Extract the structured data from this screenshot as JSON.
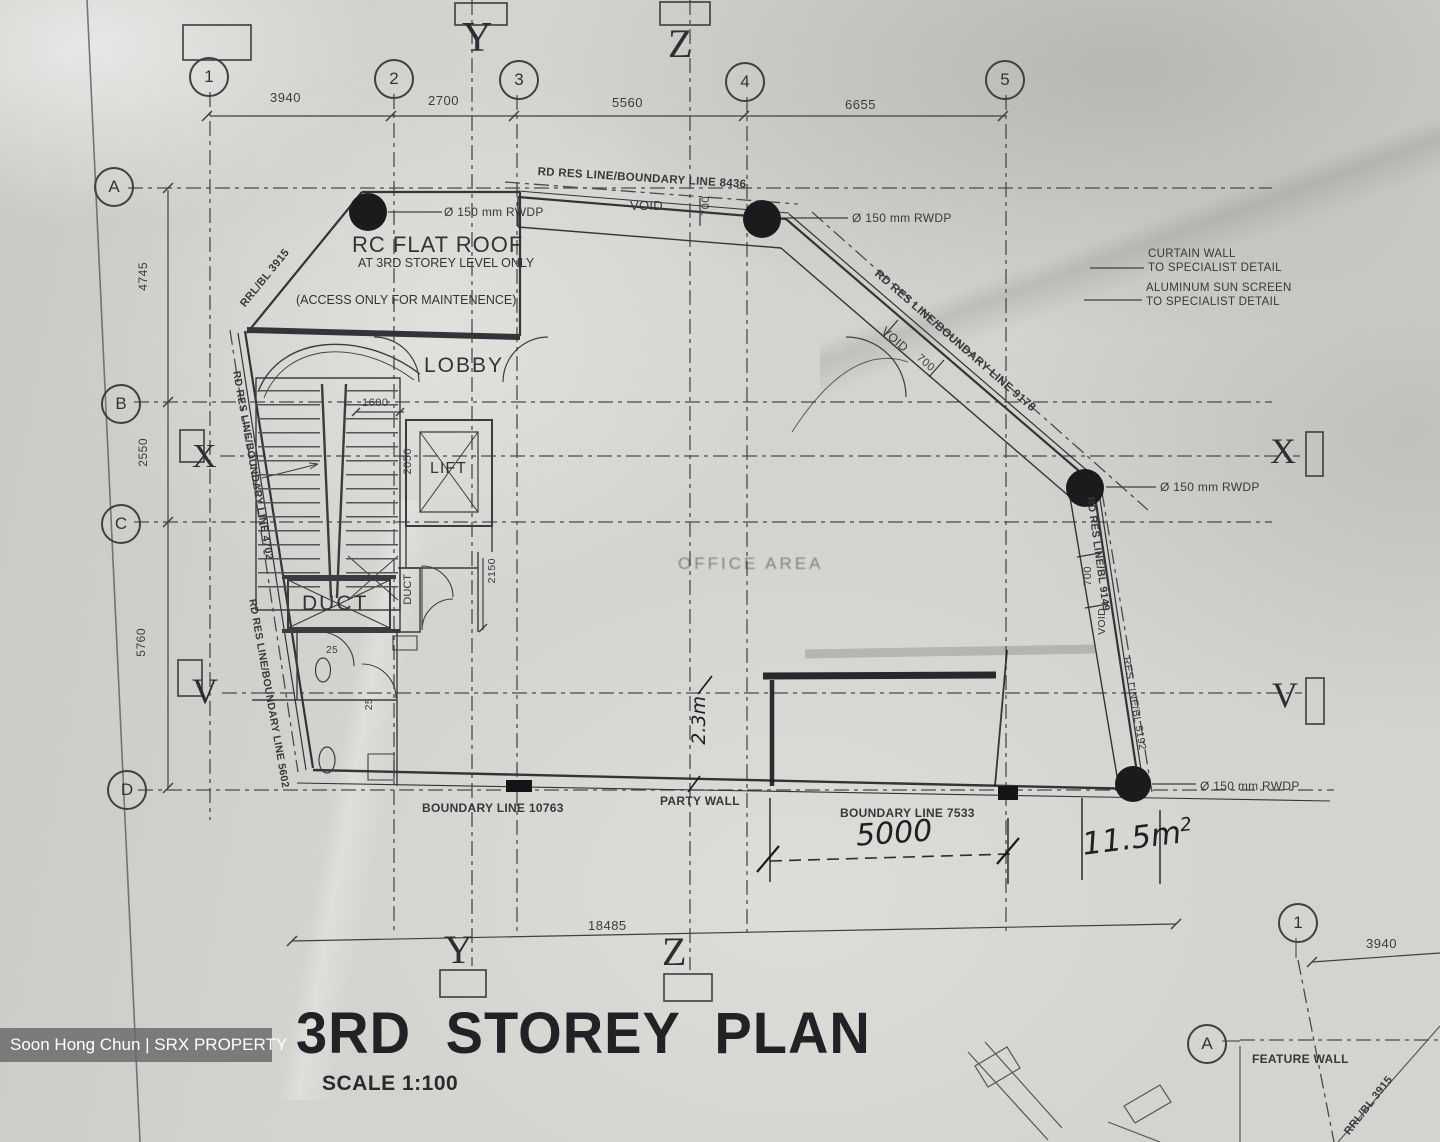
{
  "photo": {
    "watermark": "Soon Hong Chun | SRX PROPERTY"
  },
  "title_block": {
    "title": "3RD STOREY PLAN",
    "scale": "SCALE 1:100"
  },
  "grid": {
    "columns": [
      "1",
      "2",
      "3",
      "4",
      "5"
    ],
    "rows": [
      "A",
      "B",
      "C",
      "D"
    ],
    "column_dims": [
      "3940",
      "2700",
      "5560",
      "6655"
    ],
    "row_dims": [
      "4745",
      "2550",
      "5760"
    ],
    "overall_width_dim": "18485",
    "section_y": "Y",
    "section_z": "Z",
    "section_x": "X",
    "section_v": "V"
  },
  "roof": {
    "line1": "RC FLAT ROOF",
    "line2": "AT 3RD STOREY LEVEL ONLY",
    "line3": "(ACCESS ONLY FOR MAINTENENCE)"
  },
  "rooms": {
    "lobby": "LOBBY",
    "lift": "LIFT",
    "duct_main": "DUCT",
    "duct_small": "DUCT",
    "office_area": "OFFICE AREA"
  },
  "dims": {
    "lift_front": "1600",
    "lift_depth": "2050",
    "duct_depth": "2150",
    "wall_25a": "25",
    "wall_25b": "25",
    "void_top": "700",
    "void_diag": "700",
    "void_right": "700",
    "corner_dim": "3940"
  },
  "voids": {
    "top": "VOID",
    "diag": "VOID",
    "right": "VOID"
  },
  "boundaries": {
    "top": "RD RES LINE/BOUNDARY LINE 8436",
    "diagonal": "RD RES LINE/BOUNDARY LINE 9178",
    "right_upper": "RD RES LINE/BL 9149",
    "right_lower": "RES LINE/BL 5192",
    "left_upper": "RD RES LINE/BOUNDARY LINE 4702",
    "left_lower": "RD RES LINE/BOUNDARY LINE 5602",
    "bottom_left": "BOUNDARY LINE 10763",
    "bottom_right": "BOUNDARY LINE 7533",
    "party_wall": "PARTY WALL",
    "rrl_roof": "RRL/BL 3915",
    "rrl_corner": "RRL/BL 3915"
  },
  "annotations": {
    "rwdp": "Ø 150 mm RWDP",
    "curtain_wall_1": "CURTAIN WALL",
    "curtain_wall_2": "TO SPECIALIST DETAIL",
    "sun_screen_1": "ALUMINUM  SUN SCREEN",
    "sun_screen_2": "TO SPECIALIST DETAIL",
    "feature_wall": "FEATURE WALL",
    "corner_column": "1",
    "corner_row": "A"
  },
  "handwritten": {
    "dim_5000": "5000",
    "area_value": "11.5m",
    "area_sup": "2",
    "note_vertical": "2.3m"
  },
  "colors": {
    "paper": "#d5d3cf",
    "ink": "#3a3a3e",
    "pen": "#1a1a1c"
  }
}
